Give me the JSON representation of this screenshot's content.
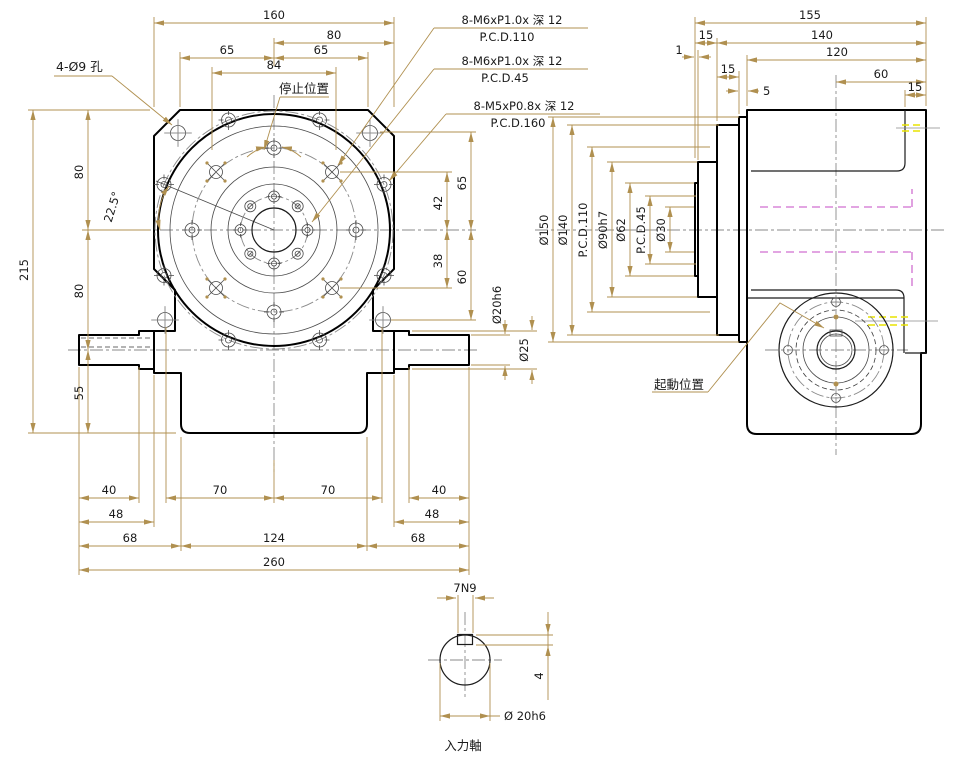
{
  "front": {
    "labels": {
      "hole_note": "4-Ø9 孔",
      "stop": "停止位置"
    },
    "callouts": {
      "c1_line1": "8-M6xP1.0x 深 12",
      "c1_line2": "P.C.D.110",
      "c2_line1": "8-M6xP1.0x 深 12",
      "c2_line2": "P.C.D.45",
      "c3_line1": "8-M5xP0.8x 深 12",
      "c3_line2": "P.C.D.160"
    },
    "dims": {
      "d160": "160",
      "d80": "80",
      "d65l": "65",
      "d65r": "65",
      "d84": "84",
      "d215": "215",
      "d80a": "80",
      "d80b": "80",
      "d55": "55",
      "d42": "42",
      "d38": "38",
      "d65v": "65",
      "d60": "60",
      "dia20": "Ø20h6",
      "dia25": "Ø25",
      "d40l": "40",
      "d70l": "70",
      "d70r": "70",
      "d40r": "40",
      "d48l": "48",
      "d48r": "48",
      "d68l": "68",
      "d124": "124",
      "d68r": "68",
      "d260": "260",
      "angle": "22.5°"
    }
  },
  "side": {
    "labels": {
      "start": "起動位置"
    },
    "dims": {
      "d155": "155",
      "d140": "140",
      "d120": "120",
      "d1": "1",
      "d15a": "15",
      "d15b": "15",
      "d5": "5",
      "d60": "60",
      "d15c": "15"
    },
    "dia": {
      "d150": "Ø150",
      "d140": "Ø140",
      "pcd110": "P.C.D.110",
      "d90": "Ø90h7",
      "d62": "Ø62",
      "pcd45": "P.C.D.45",
      "d30": "Ø30"
    }
  },
  "detail": {
    "labels": {
      "key": "7N9",
      "depth": "4",
      "dia": "Ø 20h6",
      "name": "入力軸"
    }
  },
  "colors": {
    "dimension": "#b09050",
    "outline": "#000000",
    "text": "#1a1a1a",
    "hidden_cam": "#d06fd0",
    "datum": "#e8e400",
    "centerline": "#8a8a8a",
    "background": "#ffffff"
  }
}
